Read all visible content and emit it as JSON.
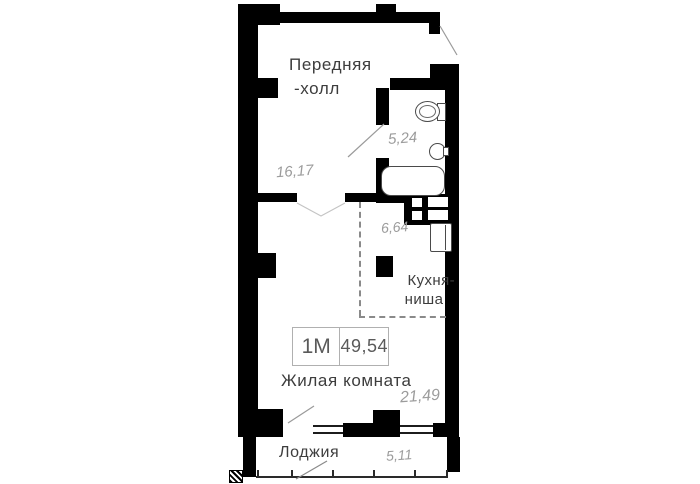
{
  "plan": {
    "stamp": {
      "apartment_type": "1М",
      "total_area": "49,54"
    },
    "rooms": {
      "hall": {
        "name_line1": "Передняя",
        "name_line2": "-холл",
        "area": "16,17"
      },
      "bathroom": {
        "area": "5,24"
      },
      "kitchen_niche": {
        "name_line1": "Кухня-",
        "name_line2": "ниша",
        "area": "6,64"
      },
      "living_room": {
        "name": "Жилая комната",
        "area": "21,49"
      },
      "loggia": {
        "name": "Лоджия",
        "area": "5,11"
      }
    }
  },
  "colors": {
    "wall": "#000000",
    "label_text": "#3d3d3d",
    "area_text": "#9c9c9c",
    "fixture_line": "#4a4a4a",
    "dashed_boundary": "#8a8a8a",
    "door_swing": "#9a9a9a",
    "stamp_border": "#b0b0b0"
  }
}
